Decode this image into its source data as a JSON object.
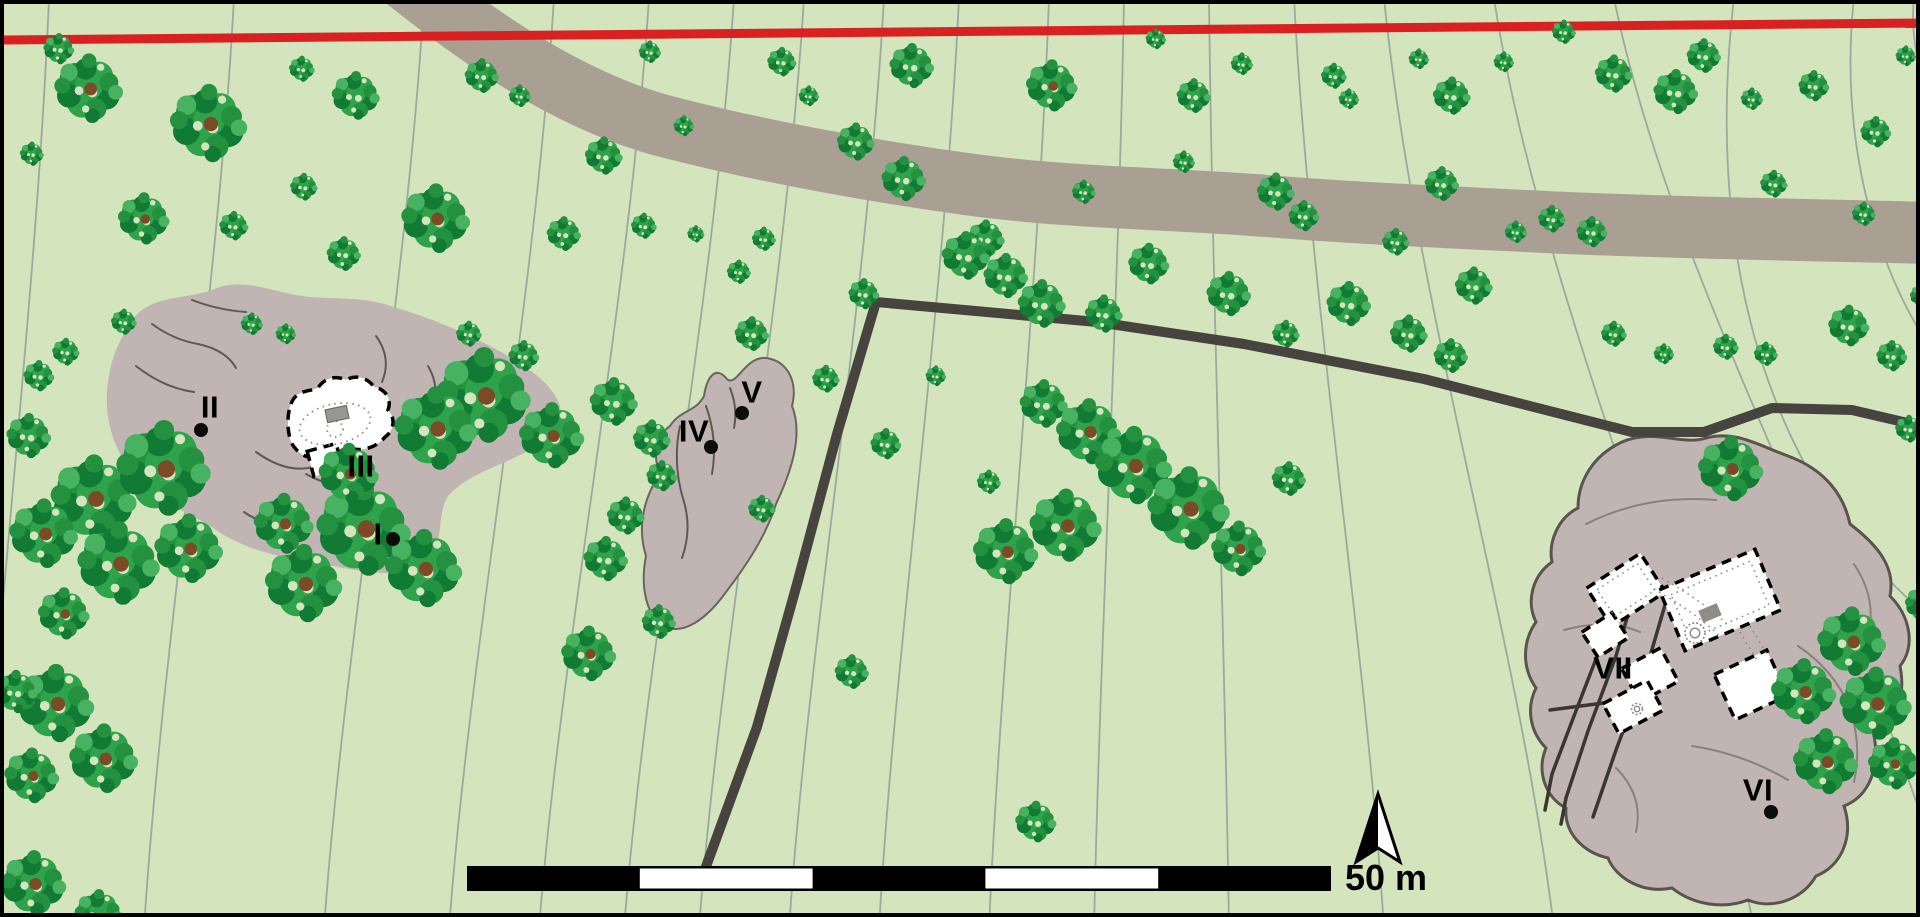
{
  "map": {
    "type": "archaeological-site-plan",
    "background_color": "#d4e4bd",
    "border_color": "#000000",
    "contours": {
      "color": "#9aaa9d",
      "width": 1.8,
      "lines": [
        {
          "t": 45,
          "b": -70
        },
        {
          "t": 230,
          "b": -90
        },
        {
          "t": 420,
          "b": -100
        },
        {
          "t": 550,
          "b": -105
        },
        {
          "t": 645,
          "b": -110
        },
        {
          "t": 730,
          "b": -110
        },
        {
          "t": 800,
          "b": -105
        },
        {
          "t": 880,
          "b": -95
        },
        {
          "t": 955,
          "b": -80
        },
        {
          "t": 1045,
          "b": -60
        },
        {
          "t": 1120,
          "b": -30
        },
        {
          "t": 1205,
          "b": 20
        },
        {
          "t": 1290,
          "b": 90
        },
        {
          "t": 1380,
          "b": 170
        },
        {
          "t": 1490,
          "b": 260
        },
        {
          "t": 1610,
          "b": 340
        }
      ],
      "extra_paths": [
        "M1730,-6 C1700,250 1760,500 1960,640",
        "M1850,-6 C1830,180 1900,330 1965,390",
        "M1910,-6 C1902,70 1945,140 1975,165"
      ]
    },
    "road": {
      "color": "#a99f92",
      "width": 62,
      "path": "M395,-30 C470,30 560,95 660,122 C760,148 862,166 962,180 C1062,194 1162,194 1262,202 C1362,210 1462,214 1562,219 C1682,224 1802,226 1930,229"
    },
    "red_line": {
      "color": "#d92121",
      "width": 9,
      "from": [
        0,
        36
      ],
      "to": [
        1920,
        19
      ]
    },
    "boundary_line": {
      "color": "#474440",
      "width": 10,
      "points": [
        [
          700,
          868
        ],
        [
          753,
          723
        ],
        [
          793,
          580
        ],
        [
          833,
          430
        ],
        [
          872,
          298
        ],
        [
          1093,
          318
        ],
        [
          1240,
          340
        ],
        [
          1420,
          375
        ],
        [
          1628,
          428
        ],
        [
          1700,
          428
        ],
        [
          1768,
          404
        ],
        [
          1848,
          406
        ],
        [
          1925,
          424
        ]
      ]
    },
    "outcrops": [
      {
        "id": "west-outcrop",
        "fill": "#c0b5b3",
        "stroke": "none",
        "stroke_width": 0,
        "path": "M128,316 C148,290 180,296 208,286 C238,272 268,288 298,292 C324,296 352,292 380,300 C414,310 448,322 486,342 C520,360 548,378 556,402 C560,424 540,440 514,452 C490,464 462,472 444,492 C430,516 444,546 416,562 C390,576 352,566 318,560 C282,554 244,548 212,526 C186,508 158,500 140,482 C114,456 98,420 104,378 C108,350 116,336 128,316 Z"
      },
      {
        "id": "middle-outcrop",
        "fill": "#c0b5b3",
        "stroke": "#6b645e",
        "stroke_width": 2,
        "path": "M700,392 C703,372 712,362 722,374 C732,386 740,352 762,354 C784,357 794,378 788,402 C800,432 786,470 772,500 C762,532 742,562 722,588 C702,616 678,632 660,622 C642,612 636,582 642,552 C632,520 642,490 656,470 C648,450 652,432 666,422 C676,406 692,408 700,392 Z"
      },
      {
        "id": "east-outcrop",
        "fill": "#c0b5b3",
        "stroke": "#5a544e",
        "stroke_width": 3,
        "path": "M1618,438 C1650,424 1678,442 1702,434 C1732,426 1756,442 1784,452 C1822,466 1840,492 1846,520 C1872,540 1892,562 1886,592 C1906,612 1912,642 1896,662 C1902,692 1892,722 1870,732 C1876,762 1866,792 1840,802 C1850,832 1838,862 1812,872 C1798,896 1768,906 1744,896 C1718,906 1688,900 1668,884 C1638,890 1612,874 1604,854 C1578,848 1560,828 1562,804 C1542,794 1532,768 1542,744 C1526,728 1522,704 1532,684 C1518,664 1518,638 1532,618 C1522,598 1528,572 1548,558 C1544,538 1554,514 1574,504 C1574,478 1588,452 1618,438 Z"
      }
    ],
    "crack_lines": {
      "color": "#5f5952",
      "width": 2,
      "paths": [
        "M148,320 q22,16 46,20 q28,6 38,24",
        "M188,296 q26,10 54,12",
        "M132,362 q28,22 58,26",
        "M252,448 q28,20 52,16 q20,-4 30,-16",
        "M302,470 q24,14 46,8",
        "M372,332 q16,22 6,46",
        "M424,362 q14,24 2,48",
        "M240,508 q20,14 40,12",
        "M676,422 q-8,38 4,76 q8,28 -2,56",
        "M702,402 q12,34 6,68",
        "M726,384 q8,20 4,40"
      ]
    },
    "dark_cracks": {
      "color": "#2f2b28",
      "width": 2.5,
      "paths": [
        "M312,466 q-8,16 -2,30 q5,12 -4,24",
        "M324,468 q6,18 -2,34 q-6,14 4,24"
      ]
    },
    "east_inner_lines": {
      "color": "#8a8179",
      "width": 2,
      "paths": [
        "M1582,520 q60,-30 130,-24",
        "M1560,626 q44,-12 76,2",
        "M1794,642 q36,24 52,62 q12,38 4,74",
        "M1688,742 q52,8 96,34",
        "M1612,764 q28,28 20,64",
        "M1850,560 q20,30 16,60"
      ]
    },
    "track_lines": {
      "color": "#3a3631",
      "width": 3.5,
      "paths": [
        "M1612,588 L1597,642 L1570,712 L1548,770 L1541,806",
        "M1629,593 L1612,652 L1584,727 L1562,794 L1557,820",
        "M1661,601 L1642,666 L1612,746 L1589,813",
        "M1546,706 L1638,694"
      ]
    },
    "buildings": {
      "fill": "#ffffff",
      "dash_stroke": "#000000",
      "west_cave": {
        "outline_path": "M287,400 C292,386 304,388 314,384 C320,374 332,371 342,376 C352,370 364,374 370,383 C382,385 388,396 384,406 C392,414 390,427 381,433 C373,443 360,447 350,445 C344,453 331,457 321,453 C309,457 297,452 291,444 C283,436 282,412 287,400 Z",
        "lower_room": {
          "cx": 321,
          "cy": 456,
          "w": 30,
          "h": 26,
          "rot": -15
        },
        "dotted_ellipse": {
          "cx": 331,
          "cy": 420,
          "rx": 36,
          "ry": 20,
          "rot": -12
        },
        "dotted_circle": {
          "cx": 331,
          "cy": 425,
          "r": 8
        },
        "gray_rect": {
          "cx": 333,
          "cy": 410,
          "w": 22,
          "h": 13,
          "rot": -12,
          "fill": "#959890"
        }
      },
      "east_complex": {
        "rooms": [
          {
            "cx": 1622,
            "cy": 586,
            "w": 64,
            "h": 46,
            "rot": -33
          },
          {
            "cx": 1601,
            "cy": 631,
            "w": 36,
            "h": 30,
            "rot": -33
          },
          {
            "cx": 1716,
            "cy": 596,
            "w": 104,
            "h": 66,
            "rot": -23
          },
          {
            "cx": 1646,
            "cy": 671,
            "w": 44,
            "h": 38,
            "rot": -28
          },
          {
            "cx": 1629,
            "cy": 703,
            "w": 50,
            "h": 34,
            "rot": -28
          },
          {
            "cx": 1747,
            "cy": 681,
            "w": 58,
            "h": 50,
            "rot": -25
          }
        ],
        "dotted_inset_rooms": [
          {
            "cx": 1716,
            "cy": 596,
            "w": 86,
            "h": 48,
            "rot": -23
          },
          {
            "cx": 1622,
            "cy": 586,
            "w": 48,
            "h": 32,
            "rot": -33
          }
        ],
        "dotted_lines": [
          "M1650,585 C1672,598 1692,610 1716,632",
          "M1658,574 C1680,587 1700,599 1724,621",
          "M1736,628 L1754,658",
          "M1746,622 L1764,652"
        ],
        "gray_rect": {
          "cx": 1706,
          "cy": 609,
          "w": 20,
          "h": 13,
          "rot": -23,
          "fill": "#8f8b85"
        },
        "circle_glyphs": [
          {
            "cx": 1691,
            "cy": 629,
            "r": 10
          },
          {
            "cx": 1633,
            "cy": 705,
            "r": 5.5
          }
        ]
      }
    },
    "sites": [
      {
        "label": "I",
        "cx": 374,
        "cy": 530,
        "dot": [
          389,
          535
        ]
      },
      {
        "label": "II",
        "cx": 206,
        "cy": 403,
        "dot": [
          197,
          426
        ]
      },
      {
        "label": "III",
        "cx": 357,
        "cy": 462,
        "dot": null
      },
      {
        "label": "IV",
        "cx": 690,
        "cy": 427,
        "dot": [
          707,
          443
        ]
      },
      {
        "label": "V",
        "cx": 748,
        "cy": 388,
        "dot": [
          738,
          409
        ]
      },
      {
        "label": "VI",
        "cx": 1754,
        "cy": 786,
        "dot": [
          1767,
          808
        ]
      },
      {
        "label": "VII",
        "cx": 1609,
        "cy": 664,
        "dot": null
      }
    ],
    "dot_radius": 7,
    "scale_bar": {
      "x": 463,
      "y": 862,
      "width": 864,
      "height": 25,
      "segment_count": 5,
      "white_segments": [
        1,
        3
      ],
      "bar_color": "#000000",
      "label": "50 m",
      "label_x": 1341,
      "label_y": 856
    },
    "north_arrow": {
      "tip": [
        1374,
        790
      ],
      "base_left": [
        1352,
        858
      ],
      "base_right": [
        1396,
        858
      ],
      "notch": [
        1374,
        844
      ],
      "left_fill": "#000000",
      "right_fill": "#ffffff"
    },
    "tree_colors": {
      "dark": "#117a33",
      "base": "#23913f",
      "mid": "#2fa24c",
      "light": "#47b261",
      "trunk": "#7c4a26"
    },
    "trees": [
      [
        85,
        85,
        40
      ],
      [
        55,
        45,
        18
      ],
      [
        28,
        150,
        14
      ],
      [
        205,
        120,
        45
      ],
      [
        298,
        65,
        15
      ],
      [
        352,
        92,
        28
      ],
      [
        300,
        183,
        16
      ],
      [
        478,
        72,
        20
      ],
      [
        516,
        92,
        13
      ],
      [
        600,
        152,
        22
      ],
      [
        646,
        48,
        13
      ],
      [
        680,
        122,
        12
      ],
      [
        778,
        58,
        17
      ],
      [
        805,
        92,
        12
      ],
      [
        852,
        138,
        22
      ],
      [
        908,
        62,
        26
      ],
      [
        1048,
        82,
        30
      ],
      [
        1152,
        35,
        12
      ],
      [
        1190,
        92,
        20
      ],
      [
        1238,
        60,
        13
      ],
      [
        1330,
        72,
        15
      ],
      [
        1345,
        95,
        12
      ],
      [
        1415,
        55,
        12
      ],
      [
        1448,
        92,
        22
      ],
      [
        1500,
        58,
        12
      ],
      [
        1560,
        28,
        14
      ],
      [
        1610,
        70,
        22
      ],
      [
        1672,
        88,
        26
      ],
      [
        1700,
        52,
        20
      ],
      [
        1748,
        95,
        13
      ],
      [
        1810,
        82,
        18
      ],
      [
        1872,
        128,
        18
      ],
      [
        1902,
        52,
        12
      ],
      [
        140,
        215,
        30
      ],
      [
        230,
        222,
        17
      ],
      [
        340,
        250,
        20
      ],
      [
        432,
        215,
        40
      ],
      [
        560,
        230,
        20
      ],
      [
        640,
        222,
        15
      ],
      [
        692,
        230,
        10
      ],
      [
        760,
        235,
        14
      ],
      [
        900,
        175,
        26
      ],
      [
        982,
        235,
        22
      ],
      [
        1080,
        188,
        14
      ],
      [
        1180,
        158,
        13
      ],
      [
        1272,
        188,
        22
      ],
      [
        1300,
        212,
        18
      ],
      [
        1392,
        238,
        16
      ],
      [
        1438,
        180,
        20
      ],
      [
        1512,
        228,
        13
      ],
      [
        1548,
        215,
        16
      ],
      [
        1588,
        228,
        18
      ],
      [
        1770,
        180,
        16
      ],
      [
        1860,
        210,
        14
      ],
      [
        735,
        268,
        14
      ],
      [
        860,
        290,
        18
      ],
      [
        962,
        252,
        28
      ],
      [
        1002,
        272,
        26
      ],
      [
        1038,
        300,
        28
      ],
      [
        1100,
        310,
        22
      ],
      [
        1145,
        260,
        24
      ],
      [
        1225,
        290,
        26
      ],
      [
        1282,
        330,
        16
      ],
      [
        1345,
        300,
        26
      ],
      [
        1405,
        330,
        22
      ],
      [
        1447,
        352,
        20
      ],
      [
        1470,
        282,
        22
      ],
      [
        1610,
        330,
        15
      ],
      [
        1660,
        350,
        12
      ],
      [
        1722,
        343,
        15
      ],
      [
        1762,
        350,
        14
      ],
      [
        1845,
        322,
        24
      ],
      [
        1888,
        352,
        18
      ],
      [
        1905,
        425,
        16
      ],
      [
        1918,
        292,
        14
      ],
      [
        35,
        372,
        18
      ],
      [
        25,
        432,
        26
      ],
      [
        120,
        318,
        15
      ],
      [
        62,
        348,
        16
      ],
      [
        248,
        320,
        13
      ],
      [
        282,
        330,
        12
      ],
      [
        465,
        330,
        15
      ],
      [
        520,
        352,
        18
      ],
      [
        480,
        392,
        55
      ],
      [
        432,
        425,
        48
      ],
      [
        548,
        432,
        38
      ],
      [
        610,
        398,
        28
      ],
      [
        648,
        435,
        22
      ],
      [
        658,
        472,
        18
      ],
      [
        622,
        512,
        22
      ],
      [
        602,
        555,
        26
      ],
      [
        748,
        330,
        20
      ],
      [
        822,
        375,
        16
      ],
      [
        882,
        440,
        18
      ],
      [
        758,
        505,
        16
      ],
      [
        932,
        372,
        12
      ],
      [
        985,
        478,
        14
      ],
      [
        1285,
        475,
        20
      ],
      [
        1727,
        465,
        38
      ],
      [
        90,
        495,
        50
      ],
      [
        160,
        465,
        55
      ],
      [
        115,
        560,
        48
      ],
      [
        40,
        530,
        40
      ],
      [
        185,
        545,
        40
      ],
      [
        60,
        610,
        30
      ],
      [
        300,
        580,
        45
      ],
      [
        360,
        525,
        55
      ],
      [
        420,
        565,
        45
      ],
      [
        345,
        470,
        35
      ],
      [
        280,
        520,
        35
      ],
      [
        1040,
        400,
        28
      ],
      [
        1085,
        428,
        38
      ],
      [
        1130,
        462,
        45
      ],
      [
        1185,
        505,
        48
      ],
      [
        1235,
        545,
        32
      ],
      [
        1062,
        522,
        42
      ],
      [
        1002,
        548,
        38
      ],
      [
        585,
        650,
        32
      ],
      [
        655,
        618,
        20
      ],
      [
        848,
        668,
        20
      ],
      [
        1032,
        818,
        24
      ],
      [
        52,
        700,
        45
      ],
      [
        100,
        755,
        40
      ],
      [
        28,
        772,
        32
      ],
      [
        12,
        688,
        25
      ],
      [
        30,
        880,
        38
      ],
      [
        95,
        910,
        28
      ],
      [
        1848,
        638,
        40
      ],
      [
        1800,
        688,
        38
      ],
      [
        1872,
        700,
        42
      ],
      [
        1822,
        758,
        38
      ],
      [
        1890,
        760,
        30
      ],
      [
        1920,
        600,
        22
      ]
    ]
  }
}
